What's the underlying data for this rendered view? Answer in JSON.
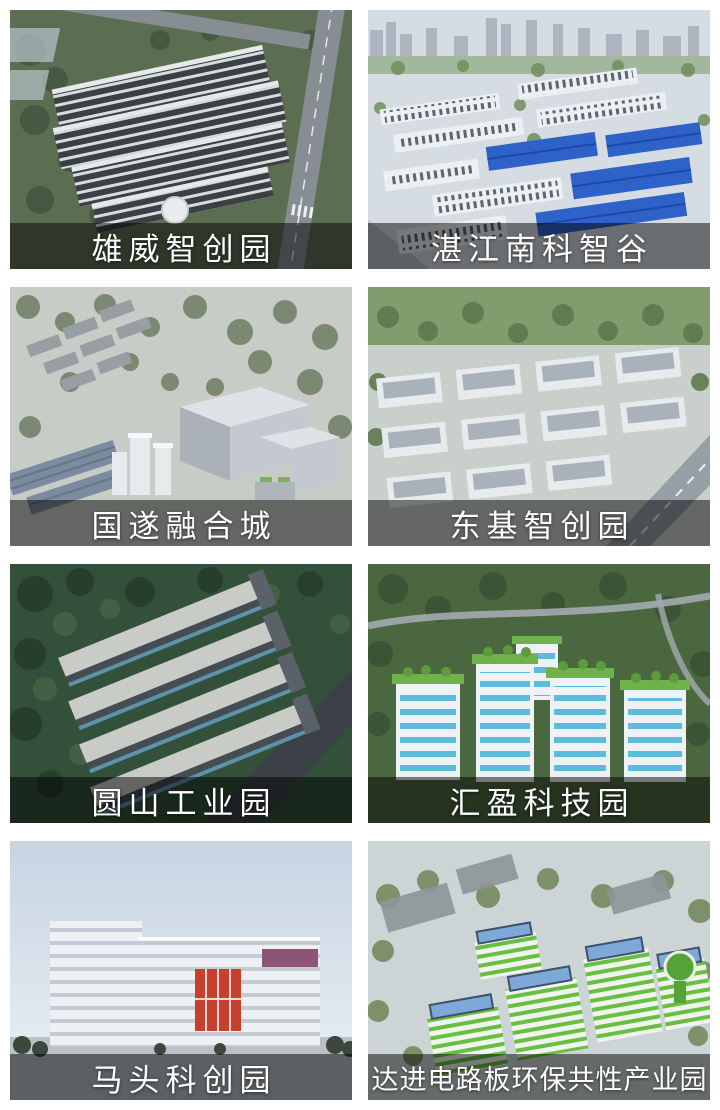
{
  "gallery": {
    "caption_overlay_color": "rgba(0,0,0,0.5)",
    "caption_text_color": "#ffffff",
    "tiles": [
      {
        "caption": "雄威智创园",
        "colors": {
          "ground": "#5c6e52",
          "tree": "#455741",
          "bld": "#3a4045",
          "stripe": "#d8dcdc",
          "glass": "#b7c6cd",
          "road": "#878e93"
        }
      },
      {
        "caption": "湛江南科智谷",
        "colors": {
          "haze": "#d6dde2",
          "city": "#a9b0bc",
          "trees": "#6f8f5a",
          "bld": "#edf0f2",
          "win": "#5a6670",
          "roof": "#2f62c8",
          "road": "#b9c0c5"
        }
      },
      {
        "caption": "国遂融合城",
        "colors": {
          "haze": "#c7ccc6",
          "trees": "#6e7d64",
          "res": "#989ea1",
          "box": "#c3c9cf",
          "boxTop": "#dfe3e7",
          "boxSide": "#aab1b8",
          "glass": "#7c8b9e",
          "tower": "#e8ebee"
        }
      },
      {
        "caption": "东基智创园",
        "colors": {
          "ground": "#c9cfcb",
          "field": "#839c6e",
          "trees": "#5d7a4e",
          "bld": "#e7ebee",
          "roof": "#a9b2ba",
          "road": "#979fa6"
        }
      },
      {
        "caption": "圆山工业园",
        "colors": {
          "forest": "#33503a",
          "forestDark": "#263d2c",
          "forestLight": "#476448",
          "roofL": "#c9cbc6",
          "side": "#454c52",
          "glass": "#5d92ab",
          "road": "#3b4146"
        }
      },
      {
        "caption": "汇盈科技园",
        "colors": {
          "trees": "#4a673f",
          "treesDark": "#3a5335",
          "road": "#a3abb0",
          "bld": "#eff2f4",
          "win": "#45b2d8",
          "roof": "#6fb24a",
          "bush": "#5d9c3c"
        }
      },
      {
        "caption": "马头科创园",
        "colors": {
          "sky1": "#c6d4e2",
          "sky2": "#edf1f5",
          "bld": "#eef1f4",
          "band": "#c3ccd4",
          "accent": "#c6402d",
          "box": "#8c5575",
          "treeline": "#3c473d",
          "ground": "#b9c0c6"
        }
      },
      {
        "caption": "达进电路板环保共性产业园",
        "colors": {
          "haze": "#ccd4d6",
          "trees": "#74895f",
          "grayBox": "#8e9599",
          "stripe": "#69bf41",
          "white": "#f0f4ee",
          "solar": "#7ea8d8",
          "solarDark": "#3d516a",
          "towerGreen": "#55a338"
        }
      }
    ]
  }
}
